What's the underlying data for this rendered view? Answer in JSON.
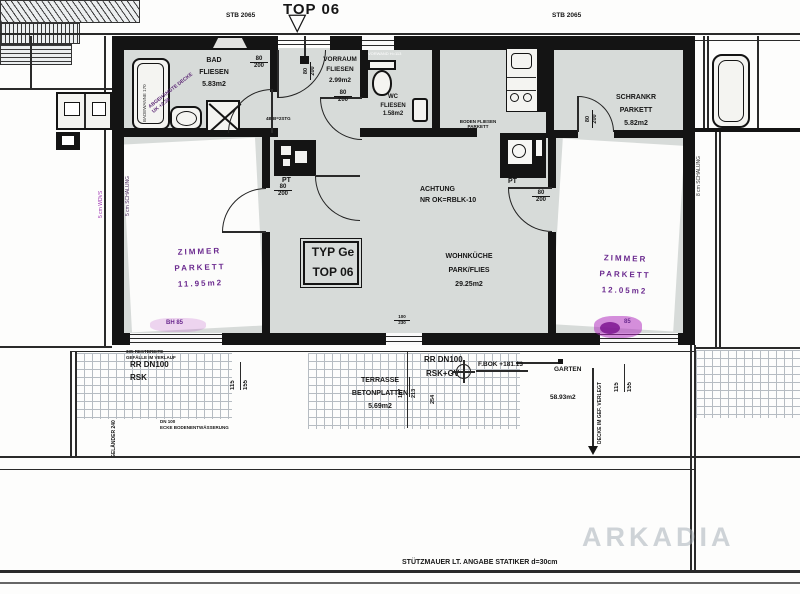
{
  "title": "TOP 06",
  "labels": {
    "stb": "STB 2065",
    "typ_line1": "TYP Ge",
    "typ_line2": "TOP 06",
    "stuetzmauer": "STÜTZMAUER LT. ANGABE STATIKER d=30cm",
    "watermark": "ARKADIA"
  },
  "rooms": {
    "bad": {
      "name": "BAD",
      "floor": "FLIESEN",
      "area": "5.83m2"
    },
    "vorraum": {
      "name": "VORRAUM",
      "floor": "FLIESEN",
      "area": "2.99m2"
    },
    "wc": {
      "name": "WC",
      "floor": "FLIESEN",
      "area": "1.58m2"
    },
    "schrankraum": {
      "name": "SCHRANKR",
      "floor": "PARKETT",
      "area": "5.82m2"
    },
    "wohnkueche": {
      "name": "WOHNKÜCHE",
      "floor": "PARK/FLIES",
      "area": "29.25m2"
    },
    "zimmer_links": {
      "name": "ZIMMER",
      "floor": "PARKETT",
      "area": "11.95m2"
    },
    "zimmer_rechts": {
      "name": "ZIMMER",
      "floor": "PARKETT",
      "area": "12.05m2"
    },
    "terrasse": {
      "name": "TERRASSE",
      "floor": "BETONPLATTEN",
      "area": "5.69m2"
    },
    "garten": {
      "name": "GARTEN",
      "area": "58.93m2"
    }
  },
  "dims": {
    "door": "80/200",
    "door_w": "80",
    "door_h": "200",
    "terr_w": "100",
    "terr_h": "230",
    "win_w": "115",
    "win_h": "155",
    "d167": "167",
    "d213": "213",
    "d254": "254",
    "gelaender": "GELÄNDER 240"
  },
  "notes": {
    "achtung1": "ACHTUNG",
    "achtung2": "NR OK=RBLK-10",
    "boden1": "BODEN FLIESEN",
    "boden2": "PARKETT",
    "abgeh1": "ABGEHÄNGTE DECKE",
    "abgeh2": "UK +2.30",
    "badewanne": "BADEWANNE 170",
    "vorwand": "VORWAND H=113",
    "stiege": "4B B=2STG",
    "pt": "PT",
    "rr": "RR DN100",
    "rsk": "RSK",
    "rskgv": "RSK+GV",
    "restbreite": "335 RESTBREITE",
    "gefaelle": "GEFÄLLE IM VERLAUF",
    "dn100": "DN 100",
    "entwaesserung": "ECKE BODENENTWÄSSERUNG",
    "fbok": "F.BOK +181.13",
    "decke_gef": "DECKE IM GEF. VERLEGT",
    "bh_links": "BH 85",
    "bh_rechts": "85",
    "daemm_a": "5 cm WDVS",
    "daemm_b": "5 cm SCHALUNG",
    "daemm_c": "8 cm SCHALUNG"
  }
}
